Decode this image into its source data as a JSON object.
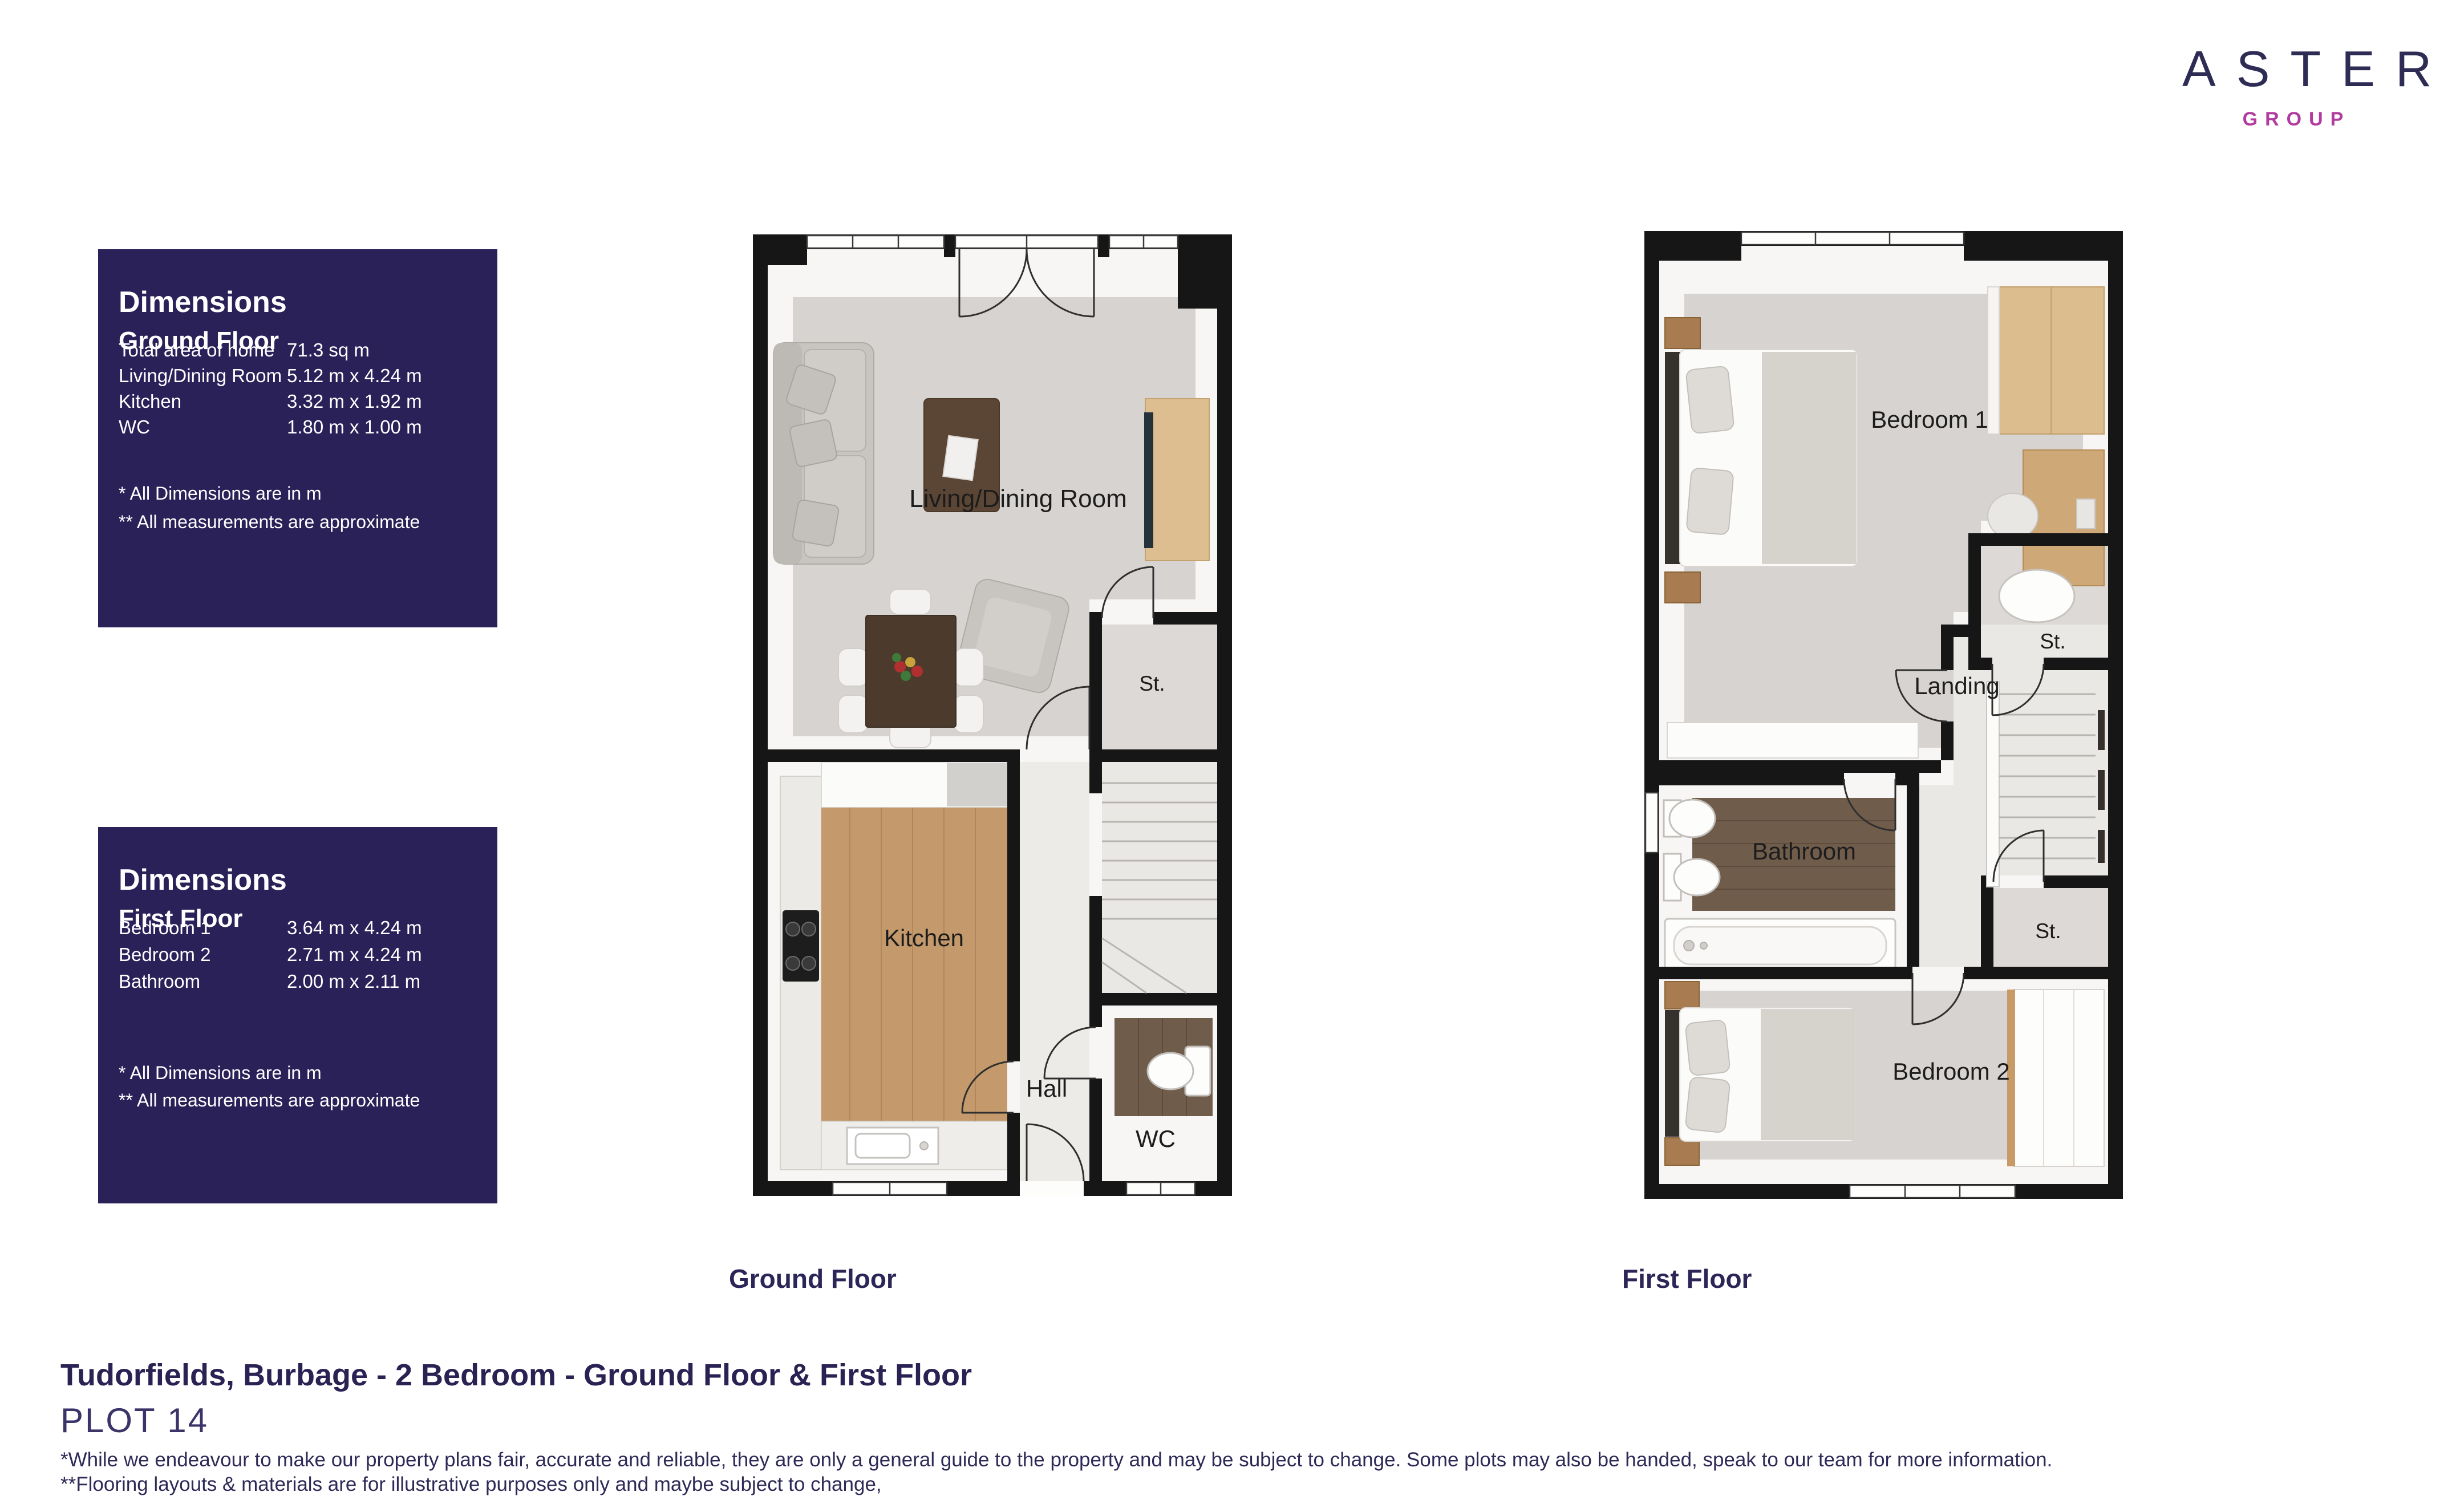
{
  "brand": {
    "name": "ASTER",
    "subname": "GROUP"
  },
  "colors": {
    "panel_navy": "#2a2159",
    "brand_navy": "#2e2c55",
    "brand_magenta": "#b13b9e",
    "heading_navy": "#2b2254"
  },
  "panels": {
    "ground": {
      "title": "Dimensions",
      "subtitle": "Ground Floor",
      "rows": [
        {
          "label": "Total area of home",
          "value": "71.3 sq m"
        },
        {
          "label": "Living/Dining Room",
          "value": "5.12 m x 4.24 m"
        },
        {
          "label": "Kitchen",
          "value": "3.32 m x 1.92 m"
        },
        {
          "label": "WC",
          "value": "1.80 m x 1.00 m"
        }
      ],
      "note1": "* All Dimensions are in m",
      "note2": "** All measurements are approximate"
    },
    "first": {
      "title": "Dimensions",
      "subtitle": "First Floor",
      "rows": [
        {
          "label": "Bedroom 1",
          "value": "3.64 m x 4.24 m"
        },
        {
          "label": "Bedroom 2",
          "value": "2.71 m x 4.24 m"
        },
        {
          "label": "Bathroom",
          "value": "2.00 m x 2.11 m"
        }
      ],
      "note1": "* All Dimensions are in m",
      "note2": "** All measurements are approximate"
    }
  },
  "plans": {
    "ground": {
      "caption": "Ground Floor",
      "labels": {
        "living": "Living/Dining Room",
        "st": "St.",
        "kitchen": "Kitchen",
        "hall": "Hall",
        "wc": "WC"
      }
    },
    "first": {
      "caption": "First Floor",
      "labels": {
        "bedroom1": "Bedroom 1",
        "st1": "St.",
        "landing": "Landing",
        "bathroom": "Bathroom",
        "st2": "St.",
        "bedroom2": "Bedroom 2"
      }
    }
  },
  "footer": {
    "title": "Tudorfields, Burbage - 2 Bedroom  - Ground Floor & First Floor",
    "plot": "PLOT 14",
    "disclaimer1": "*While we endeavour to make our property plans fair, accurate and reliable, they are only a general guide to the property and may be subject to change. Some plots may also be handed, speak to our team for more information.",
    "disclaimer2": "**Flooring layouts & materials are for illustrative purposes only and maybe subject to change,"
  }
}
